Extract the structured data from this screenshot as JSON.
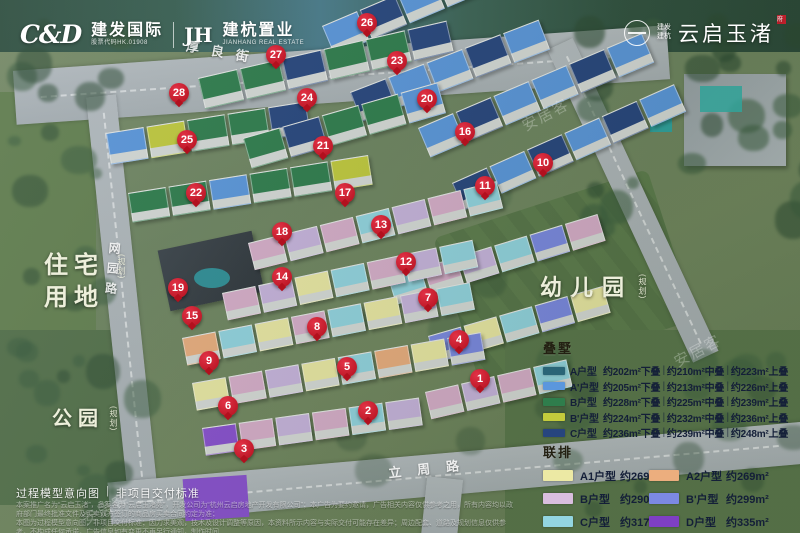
{
  "header": {
    "brand_left": {
      "cd_logo": "C&D",
      "cd_name": "建发国际",
      "cd_sub": "股票代码HK.01908",
      "jh_logo": "JH",
      "jh_name": "建杭置业",
      "jh_sub": "JIANHANG REAL ESTATE"
    },
    "brand_right": {
      "mini_top": "建发",
      "mini_bottom": "建杭",
      "project_name": "云启玉渚",
      "seal": "府",
      "seal_color": "#c0202c"
    }
  },
  "map": {
    "area_labels": [
      {
        "key": "residential",
        "text": "住宅用地",
        "note": "(规划)"
      },
      {
        "key": "park",
        "text": "公园",
        "note": "(规划)"
      },
      {
        "key": "kindergarten",
        "text": "幼儿园",
        "note": "(规划)"
      }
    ],
    "road_labels": [
      {
        "key": "houliang",
        "text": "厚良街"
      },
      {
        "key": "wangyuan",
        "text": "网园路"
      },
      {
        "key": "lizhou",
        "text": "立周路"
      }
    ],
    "markers": [
      {
        "n": 1,
        "x": 480,
        "y": 379
      },
      {
        "n": 2,
        "x": 368,
        "y": 411
      },
      {
        "n": 3,
        "x": 244,
        "y": 449
      },
      {
        "n": 4,
        "x": 459,
        "y": 340
      },
      {
        "n": 5,
        "x": 347,
        "y": 367
      },
      {
        "n": 6,
        "x": 228,
        "y": 406
      },
      {
        "n": 7,
        "x": 428,
        "y": 298
      },
      {
        "n": 8,
        "x": 317,
        "y": 327
      },
      {
        "n": 9,
        "x": 209,
        "y": 361
      },
      {
        "n": 10,
        "x": 543,
        "y": 163
      },
      {
        "n": 11,
        "x": 485,
        "y": 186
      },
      {
        "n": 12,
        "x": 406,
        "y": 262
      },
      {
        "n": 13,
        "x": 381,
        "y": 225
      },
      {
        "n": 14,
        "x": 282,
        "y": 277
      },
      {
        "n": 15,
        "x": 192,
        "y": 316
      },
      {
        "n": 16,
        "x": 465,
        "y": 132
      },
      {
        "n": 17,
        "x": 345,
        "y": 193
      },
      {
        "n": 18,
        "x": 282,
        "y": 232
      },
      {
        "n": 19,
        "x": 178,
        "y": 288
      },
      {
        "n": 20,
        "x": 427,
        "y": 99
      },
      {
        "n": 21,
        "x": 323,
        "y": 146
      },
      {
        "n": 22,
        "x": 196,
        "y": 193
      },
      {
        "n": 23,
        "x": 397,
        "y": 61
      },
      {
        "n": 24,
        "x": 307,
        "y": 98
      },
      {
        "n": 25,
        "x": 187,
        "y": 140
      },
      {
        "n": 26,
        "x": 367,
        "y": 23
      },
      {
        "n": 27,
        "x": 276,
        "y": 55
      },
      {
        "n": 28,
        "x": 179,
        "y": 93
      }
    ]
  },
  "legend_stack": {
    "title": "叠墅",
    "sep": "|",
    "rows": [
      {
        "color": "#2a6577",
        "label": "A户型",
        "specs": [
          "约202m²下叠",
          "约210m²中叠",
          "约223m²上叠"
        ]
      },
      {
        "color": "#5b97dd",
        "label": "A'户型",
        "specs": [
          "约205m²下叠",
          "约213m²中叠",
          "约226m²上叠"
        ]
      },
      {
        "color": "#2f7d4c",
        "label": "B户型",
        "specs": [
          "约228m²下叠",
          "约225m²中叠",
          "约239m²上叠"
        ]
      },
      {
        "color": "#c3cb3c",
        "label": "B'户型",
        "specs": [
          "约224m²下叠",
          "约232m²中叠",
          "约236m²上叠"
        ]
      },
      {
        "color": "#27457e",
        "label": "C户型",
        "specs": [
          "约236m²下叠",
          "约239m²中叠",
          "约248m²上叠"
        ]
      }
    ]
  },
  "legend_town": {
    "title": "联排",
    "items": [
      {
        "color": "#ece9a4",
        "label": "A1户型",
        "area": "约269m²"
      },
      {
        "color": "#ecae7e",
        "label": "A2户型",
        "area": "约269m²"
      },
      {
        "color": "#d9bede",
        "label": "B户型",
        "area": "约290m²"
      },
      {
        "color": "#7c89e3",
        "label": "B'户型",
        "area": "约299m²"
      },
      {
        "color": "#93d5e1",
        "label": "C户型",
        "area": "约317m²"
      },
      {
        "color": "#7e3fc4",
        "label": "D户型",
        "area": "约335m²"
      }
    ]
  },
  "footer": {
    "caption_left": "过程模型意向图",
    "caption_sep": "|",
    "caption_right": "非项目交付标准",
    "disclaimer_lines": [
      "本案推广名为“云启玉渚”，备案名为“云启玉渚苑”，开发公司为“杭州云启房地产开发有限公司”；本广告为要约邀请，广告相关内容仅供参考之用，所有内容均以政府部门最终批准文件及买卖双方签订的商品房买卖合同约定为准；",
      "本图为过程模型意向图，非项目交付标准；因力求美观，技术及设计调整等原因，本资料所示内容与实际交付可能存在差异；周边配套、道路及规划信息仅供参考，不构成任何承诺，广告信息如有变更不再另行通知，制作时间",
      "2025年7月，信息更新至2025年7月。以上规划信息来源杭州市人民政府网站及相关部门公示文件：https://www.hangzhou.gov.cn/art/2024/12/6/art_1229179511_4319790.html"
    ]
  },
  "watermark_text": "安居客",
  "decor_rows": [
    {
      "x": 322,
      "y": 26,
      "rot": -23,
      "w": 36,
      "h": 30,
      "segs": [
        "#5b97dd",
        "#27457e",
        "#5b97dd",
        "#5b97dd",
        "#27457e"
      ]
    },
    {
      "x": 198,
      "y": 78,
      "rot": -13,
      "w": 38,
      "h": 30,
      "segs": [
        "#2f7d4c",
        "#2f7d4c",
        "#27457e",
        "#2f7d4c",
        "#2f7d4c",
        "#27457e"
      ]
    },
    {
      "x": 350,
      "y": 92,
      "rot": -21,
      "w": 36,
      "h": 30,
      "segs": [
        "#27457e",
        "#5b97dd",
        "#5b97dd",
        "#27457e",
        "#5b97dd"
      ]
    },
    {
      "x": 106,
      "y": 133,
      "rot": -9,
      "w": 36,
      "h": 30,
      "segs": [
        "#5b97dd",
        "#c3cb3c",
        "#2f7d4c",
        "#2f7d4c",
        "#27457e"
      ]
    },
    {
      "x": 243,
      "y": 138,
      "rot": -16,
      "w": 36,
      "h": 30,
      "segs": [
        "#2f7d4c",
        "#27457e",
        "#2f7d4c",
        "#2f7d4c",
        "#5b97dd"
      ]
    },
    {
      "x": 418,
      "y": 128,
      "rot": -23,
      "w": 36,
      "h": 30,
      "segs": [
        "#5b97dd",
        "#27457e",
        "#5b97dd",
        "#5b97dd",
        "#27457e",
        "#5b97dd"
      ]
    },
    {
      "x": 128,
      "y": 193,
      "rot": -9,
      "w": 36,
      "h": 28,
      "segs": [
        "#2f7d4c",
        "#2f7d4c",
        "#5b97dd",
        "#2f7d4c",
        "#2f7d4c",
        "#c3cb3c"
      ]
    },
    {
      "x": 452,
      "y": 183,
      "rot": -24,
      "w": 36,
      "h": 28,
      "segs": [
        "#27457e",
        "#5b97dd",
        "#27457e",
        "#5b97dd",
        "#27457e",
        "#5b97dd"
      ]
    },
    {
      "x": 248,
      "y": 243,
      "rot": -14,
      "w": 32,
      "h": 26,
      "segs": [
        "#d9aecb",
        "#c9b4de",
        "#d9aecb",
        "#93d5e1",
        "#c9b4de",
        "#d9aecb",
        "#93d5e1"
      ]
    },
    {
      "x": 388,
      "y": 278,
      "rot": -17,
      "w": 32,
      "h": 26,
      "segs": [
        "#93d5e1",
        "#d9aecb",
        "#c9b4de",
        "#93d5e1",
        "#7c89e3",
        "#d9aecb"
      ]
    },
    {
      "x": 222,
      "y": 293,
      "rot": -12,
      "w": 32,
      "h": 26,
      "segs": [
        "#d9aecb",
        "#c9b4de",
        "#ece9a4",
        "#93d5e1",
        "#d9aecb",
        "#c9b4de",
        "#93d5e1"
      ]
    },
    {
      "x": 182,
      "y": 338,
      "rot": -11,
      "w": 32,
      "h": 26,
      "segs": [
        "#ecae7e",
        "#93d5e1",
        "#ece9a4",
        "#d9aecb",
        "#93d5e1",
        "#ece9a4",
        "#c9b4de",
        "#93d5e1"
      ]
    },
    {
      "x": 428,
      "y": 336,
      "rot": -16,
      "w": 32,
      "h": 26,
      "segs": [
        "#7c89e3",
        "#ece9a4",
        "#93d5e1",
        "#7c89e3",
        "#ece9a4"
      ]
    },
    {
      "x": 192,
      "y": 383,
      "rot": -10,
      "w": 32,
      "h": 26,
      "segs": [
        "#ece9a4",
        "#d9aecb",
        "#c9b4de",
        "#ece9a4",
        "#93d5e1",
        "#ecae7e",
        "#ece9a4",
        "#7c89e3"
      ]
    },
    {
      "x": 202,
      "y": 428,
      "rot": -8,
      "w": 32,
      "h": 26,
      "segs": [
        "#8a4fd0",
        "#d9aecb",
        "#c9b4de",
        "#d9aecb",
        "#93d5e1",
        "#c9b4de"
      ]
    },
    {
      "x": 425,
      "y": 392,
      "rot": -13,
      "w": 32,
      "h": 26,
      "segs": [
        "#d9aecb",
        "#c9b4de",
        "#d9aecb",
        "#93d5e1"
      ]
    }
  ]
}
